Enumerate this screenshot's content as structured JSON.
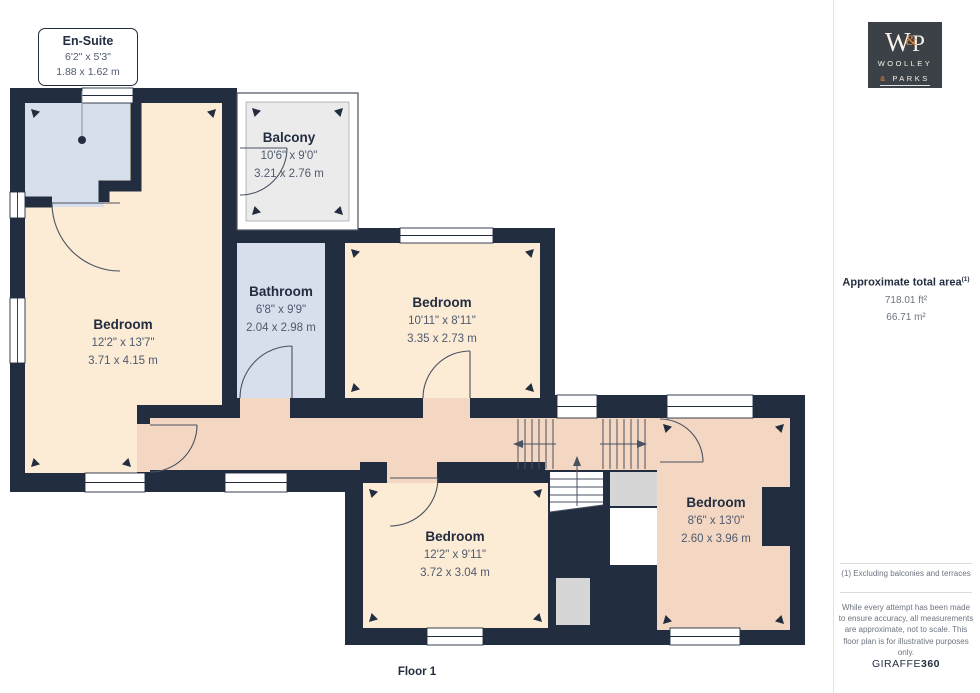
{
  "callout": {
    "title": "En-Suite",
    "dims_ft": "6'2\" x 5'3\"",
    "dims_m": "1.88 x 1.62 m"
  },
  "rooms": {
    "balcony": {
      "name": "Balcony",
      "dims_ft": "10'6\" x 9'0\"",
      "dims_m": "3.21 x 2.76 m"
    },
    "bedroom_left": {
      "name": "Bedroom",
      "dims_ft": "12'2\" x 13'7\"",
      "dims_m": "3.71 x 4.15 m"
    },
    "bathroom": {
      "name": "Bathroom",
      "dims_ft": "6'8\" x 9'9\"",
      "dims_m": "2.04 x 2.98 m"
    },
    "bedroom_middle": {
      "name": "Bedroom",
      "dims_ft": "10'11\" x 8'11\"",
      "dims_m": "3.35 x 2.73 m"
    },
    "bedroom_bottom": {
      "name": "Bedroom",
      "dims_ft": "12'2\" x 9'11\"",
      "dims_m": "3.72 x 3.04 m"
    },
    "bedroom_right": {
      "name": "Bedroom",
      "dims_ft": "8'6\" x 13'0\"",
      "dims_m": "2.60 x 3.96 m"
    }
  },
  "floor_label": "Floor 1",
  "sidebar": {
    "logo": {
      "mono_w": "W",
      "mono_amp": "&",
      "mono_p": "P",
      "line1": "WOOLLEY",
      "line2_amp": "&",
      "line2_text": "PARKS"
    },
    "area_title": "Approximate total area",
    "area_superscript": "(1)",
    "area_ft": "718.01 ft²",
    "area_m": "66.71 m²",
    "footnote": "(1) Excluding balconies and terraces",
    "disclaimer": "While every attempt has been made to ensure accuracy, all measurements are approximate, not to scale. This floor plan is for illustrative purposes only.",
    "brand": "GIRAFFE",
    "brand_suffix": "360"
  },
  "colors": {
    "wall": "#232d40",
    "cream": "#fcebd5",
    "salmon": "#f3d7c3",
    "blue": "#d7deec",
    "balcony": "#ebebeb",
    "grey": "#d6d6d6",
    "orange": "#dd8a3f",
    "logobg": "#3b4147"
  }
}
